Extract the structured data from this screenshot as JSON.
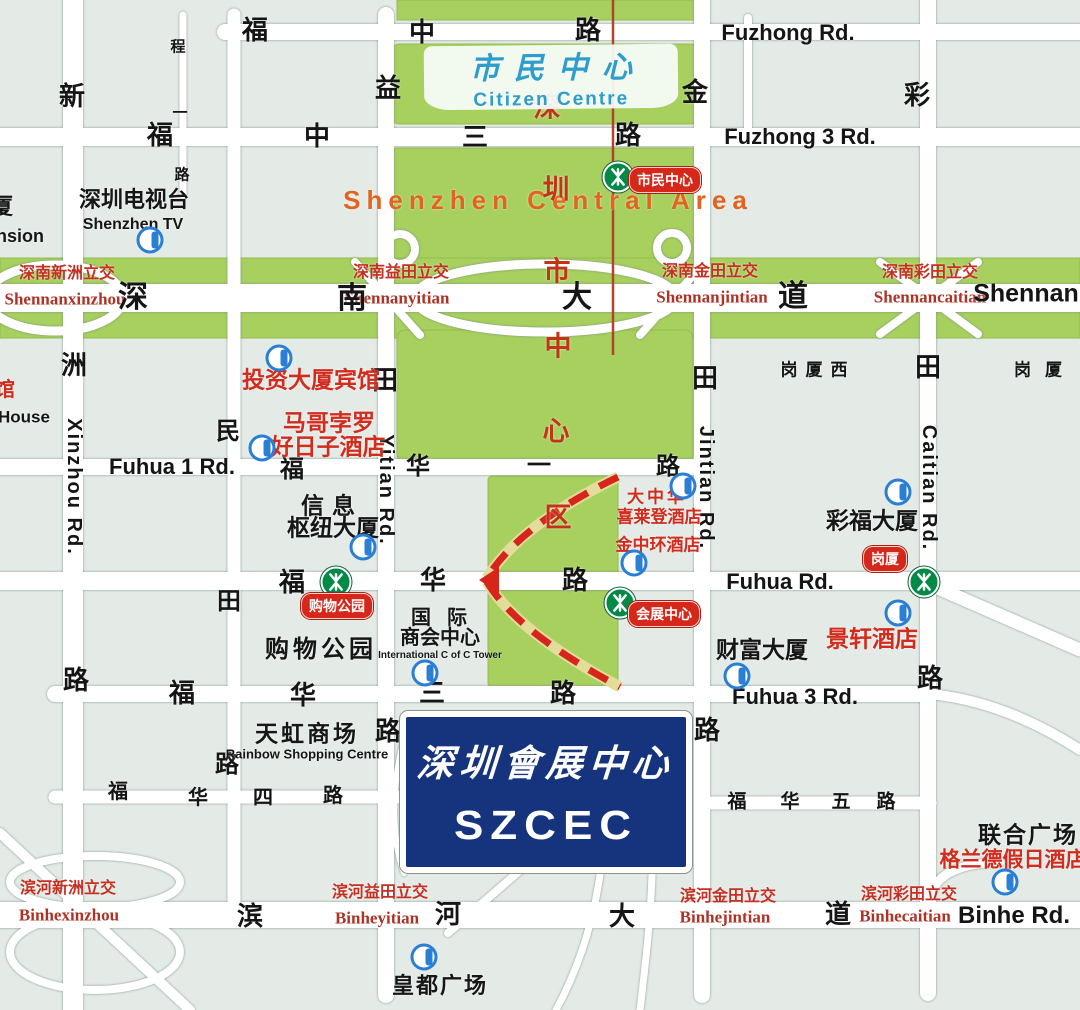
{
  "map": {
    "title": "SZCEC location map, Shenzhen Central Area",
    "colors": {
      "green_area": "#a7d05e",
      "block": "#e4ebe7",
      "road": "#ffffff",
      "szcec_blue": "#16337d",
      "red_label": "#d12c1d",
      "interchange_red": "#c53023",
      "orange_label": "#e2641e",
      "blue_label": "#2e9ccc",
      "metro_green": "#008a45",
      "badge_red": "#d6281a",
      "info_blue": "#2a7fd4",
      "axis_line_red": "#b5432a"
    },
    "citizen_centre": {
      "zh": "市民中心",
      "en": "Citizen Centre"
    },
    "szcec": {
      "zh": "深圳會展中心",
      "en": "SZCEC"
    },
    "central_area_en": "Shenzhen Central Area",
    "axis_text_vertical": "深圳市中心区",
    "labels": [
      {
        "n": "central-area-en",
        "t": "Shenzhen Central Area",
        "x": 548,
        "y": 200,
        "c": "orange",
        "fs": 26,
        "ls": 6
      },
      {
        "n": "axis-char",
        "t": "深",
        "x": 547,
        "y": 108,
        "c": "axis"
      },
      {
        "n": "axis-char",
        "t": "圳",
        "x": 556,
        "y": 190,
        "c": "axis"
      },
      {
        "n": "axis-char",
        "t": "市",
        "x": 557,
        "y": 272,
        "c": "axis"
      },
      {
        "n": "axis-char",
        "t": "中",
        "x": 558,
        "y": 347,
        "c": "axis"
      },
      {
        "n": "axis-char",
        "t": "心",
        "x": 556,
        "y": 432,
        "c": "axis"
      },
      {
        "n": "axis-char",
        "t": "区",
        "x": 558,
        "y": 518,
        "c": "axis"
      },
      {
        "n": "interchange-zh",
        "t": "深南新洲立交",
        "x": 67,
        "y": 274,
        "c": "izh"
      },
      {
        "n": "interchange-en",
        "t": "Shennanxinzhou",
        "x": 65,
        "y": 299,
        "c": "ien"
      },
      {
        "n": "interchange-zh",
        "t": "深南益田立交",
        "x": 401,
        "y": 273,
        "c": "izh"
      },
      {
        "n": "interchange-en",
        "t": "Shennanyitian",
        "x": 397,
        "y": 298,
        "c": "ien"
      },
      {
        "n": "interchange-zh",
        "t": "深南金田立交",
        "x": 710,
        "y": 272,
        "c": "izh"
      },
      {
        "n": "interchange-en",
        "t": "Shennanjintian",
        "x": 712,
        "y": 297,
        "c": "ien"
      },
      {
        "n": "interchange-zh",
        "t": "深南彩田立交",
        "x": 930,
        "y": 273,
        "c": "izh"
      },
      {
        "n": "interchange-en",
        "t": "Shennancaitian",
        "x": 930,
        "y": 297,
        "c": "ien"
      },
      {
        "n": "interchange-zh",
        "t": "滨河新洲立交",
        "x": 68,
        "y": 889,
        "c": "izh"
      },
      {
        "n": "interchange-en",
        "t": "Binhexinzhou",
        "x": 69,
        "y": 915,
        "c": "ien"
      },
      {
        "n": "interchange-zh",
        "t": "滨河益田立交",
        "x": 380,
        "y": 893,
        "c": "izh"
      },
      {
        "n": "interchange-en",
        "t": "Binheyitian",
        "x": 377,
        "y": 918,
        "c": "ien"
      },
      {
        "n": "interchange-zh",
        "t": "滨河金田立交",
        "x": 728,
        "y": 897,
        "c": "izh"
      },
      {
        "n": "interchange-en",
        "t": "Binhejintian",
        "x": 725,
        "y": 917,
        "c": "ien"
      },
      {
        "n": "interchange-zh",
        "t": "滨河彩田立交",
        "x": 909,
        "y": 895,
        "c": "izh"
      },
      {
        "n": "interchange-en",
        "t": "Binhecaitian",
        "x": 905,
        "y": 916,
        "c": "ien"
      },
      {
        "n": "road-char-fuzhong",
        "t": "福",
        "x": 255,
        "y": 30,
        "c": "rc"
      },
      {
        "n": "road-char-fuzhong",
        "t": "中",
        "x": 422,
        "y": 32,
        "c": "rc"
      },
      {
        "n": "road-char-fuzhong",
        "t": "路",
        "x": 588,
        "y": 30,
        "c": "rc"
      },
      {
        "n": "road-name-fuzhong-en",
        "t": "Fuzhong Rd.",
        "x": 788,
        "y": 33,
        "c": "re",
        "fs": 22
      },
      {
        "n": "road-char-fuzhong3",
        "t": "福",
        "x": 160,
        "y": 135,
        "c": "rc"
      },
      {
        "n": "road-char-fuzhong3",
        "t": "中",
        "x": 317,
        "y": 136,
        "c": "rc"
      },
      {
        "n": "road-char-fuzhong3",
        "t": "三",
        "x": 475,
        "y": 137,
        "c": "rc"
      },
      {
        "n": "road-char-fuzhong3",
        "t": "路",
        "x": 628,
        "y": 135,
        "c": "rc"
      },
      {
        "n": "road-name-fuzhong3-en",
        "t": "Fuzhong 3 Rd.",
        "x": 800,
        "y": 137,
        "c": "re",
        "fs": 22
      },
      {
        "n": "road-char-shennan",
        "t": "深",
        "x": 133,
        "y": 298,
        "c": "rc",
        "fs": 30
      },
      {
        "n": "road-char-shennan",
        "t": "南",
        "x": 352,
        "y": 299,
        "c": "rc",
        "fs": 30
      },
      {
        "n": "road-char-shennan",
        "t": "大",
        "x": 577,
        "y": 298,
        "c": "rc",
        "fs": 30
      },
      {
        "n": "road-char-shennan",
        "t": "道",
        "x": 793,
        "y": 297,
        "c": "rc",
        "fs": 30
      },
      {
        "n": "road-name-shennan-en",
        "t": "Shennan",
        "x": 1026,
        "y": 294,
        "c": "re",
        "fs": 25
      },
      {
        "n": "road-name-fuhua1-en",
        "t": "Fuhua 1 Rd.",
        "x": 172,
        "y": 467,
        "c": "re",
        "fs": 22
      },
      {
        "n": "road-char-fuhua1",
        "t": "福",
        "x": 292,
        "y": 470,
        "c": "rc",
        "fs": 24
      },
      {
        "n": "road-char-fuhua1",
        "t": "华",
        "x": 418,
        "y": 467,
        "c": "rc",
        "fs": 24
      },
      {
        "n": "road-char-fuhua1",
        "t": "一",
        "x": 539,
        "y": 466,
        "c": "rc",
        "fs": 24
      },
      {
        "n": "road-char-fuhua1",
        "t": "路",
        "x": 668,
        "y": 467,
        "c": "rc",
        "fs": 24
      },
      {
        "n": "road-char-fuhua",
        "t": "福",
        "x": 292,
        "y": 582,
        "c": "rc"
      },
      {
        "n": "road-char-fuhua",
        "t": "华",
        "x": 433,
        "y": 580,
        "c": "rc"
      },
      {
        "n": "road-char-fuhua",
        "t": "路",
        "x": 575,
        "y": 580,
        "c": "rc"
      },
      {
        "n": "road-name-fuhua-en",
        "t": "Fuhua Rd.",
        "x": 780,
        "y": 582,
        "c": "re",
        "fs": 22
      },
      {
        "n": "road-char-fuhua3",
        "t": "福",
        "x": 182,
        "y": 693,
        "c": "rc"
      },
      {
        "n": "road-char-fuhua3",
        "t": "华",
        "x": 303,
        "y": 695,
        "c": "rc"
      },
      {
        "n": "road-char-fuhua3",
        "t": "三",
        "x": 432,
        "y": 693,
        "c": "rc"
      },
      {
        "n": "road-char-fuhua3",
        "t": "路",
        "x": 563,
        "y": 693,
        "c": "rc"
      },
      {
        "n": "road-name-fuhua3-en",
        "t": "Fuhua 3 Rd.",
        "x": 795,
        "y": 697,
        "c": "re",
        "fs": 22
      },
      {
        "n": "road-char-fuhua4",
        "t": "福",
        "x": 118,
        "y": 792,
        "c": "rc",
        "fs": 20
      },
      {
        "n": "road-char-fuhua4",
        "t": "华",
        "x": 198,
        "y": 798,
        "c": "rc",
        "fs": 20
      },
      {
        "n": "road-char-fuhua4",
        "t": "四",
        "x": 263,
        "y": 798,
        "c": "rc",
        "fs": 20
      },
      {
        "n": "road-char-fuhua4",
        "t": "路",
        "x": 333,
        "y": 796,
        "c": "rc",
        "fs": 20
      },
      {
        "n": "road-char-fuhua5",
        "t": "福",
        "x": 737,
        "y": 802,
        "c": "rc",
        "fs": 19
      },
      {
        "n": "road-char-fuhua5",
        "t": "华",
        "x": 790,
        "y": 802,
        "c": "rc",
        "fs": 19
      },
      {
        "n": "road-char-fuhua5",
        "t": "五",
        "x": 841,
        "y": 802,
        "c": "rc",
        "fs": 19
      },
      {
        "n": "road-char-fuhua5",
        "t": "路",
        "x": 886,
        "y": 802,
        "c": "rc",
        "fs": 19
      },
      {
        "n": "road-char-binhe",
        "t": "滨",
        "x": 250,
        "y": 916,
        "c": "rc"
      },
      {
        "n": "road-char-binhe",
        "t": "河",
        "x": 448,
        "y": 914,
        "c": "rc"
      },
      {
        "n": "road-char-binhe",
        "t": "大",
        "x": 622,
        "y": 916,
        "c": "rc"
      },
      {
        "n": "road-char-binhe",
        "t": "道",
        "x": 838,
        "y": 914,
        "c": "rc"
      },
      {
        "n": "road-name-binhe-en",
        "t": "Binhe Rd.",
        "x": 1014,
        "y": 916,
        "c": "re",
        "fs": 24
      },
      {
        "n": "road-char-xinzhou",
        "t": "新",
        "x": 72,
        "y": 96,
        "c": "rc"
      },
      {
        "n": "road-char-xinzhou",
        "t": "洲",
        "x": 74,
        "y": 365,
        "c": "rc"
      },
      {
        "n": "road-name-xinzhou-en",
        "t": "Xinzhou Rd.",
        "x": 74,
        "y": 487,
        "c": "re vert",
        "fs": 20
      },
      {
        "n": "road-char-xinzhou",
        "t": "路",
        "x": 76,
        "y": 680,
        "c": "rc"
      },
      {
        "n": "road-char-chengyi",
        "t": "程",
        "x": 178,
        "y": 47,
        "c": "rc",
        "fs": 15
      },
      {
        "n": "road-char-chengyi",
        "t": "一",
        "x": 180,
        "y": 113,
        "c": "rc",
        "fs": 15
      },
      {
        "n": "road-char-chengyi",
        "t": "路",
        "x": 182,
        "y": 175,
        "c": "rc",
        "fs": 15
      },
      {
        "n": "road-char-mintian",
        "t": "民",
        "x": 228,
        "y": 432,
        "c": "rc",
        "fs": 24
      },
      {
        "n": "road-char-mintian",
        "t": "田",
        "x": 229,
        "y": 602,
        "c": "rc",
        "fs": 24
      },
      {
        "n": "road-char-mintian",
        "t": "路",
        "x": 227,
        "y": 765,
        "c": "rc",
        "fs": 24
      },
      {
        "n": "road-char-yitian",
        "t": "益",
        "x": 388,
        "y": 88,
        "c": "rc"
      },
      {
        "n": "road-char-yitian",
        "t": "田",
        "x": 385,
        "y": 380,
        "c": "rc"
      },
      {
        "n": "road-name-yitian-en",
        "t": "Yitian Rd.",
        "x": 386,
        "y": 490,
        "c": "re vert",
        "fs": 20
      },
      {
        "n": "road-char-yitian",
        "t": "路",
        "x": 388,
        "y": 731,
        "c": "rc"
      },
      {
        "n": "road-char-jintian",
        "t": "金",
        "x": 695,
        "y": 92,
        "c": "rc"
      },
      {
        "n": "road-char-jintian",
        "t": "田",
        "x": 705,
        "y": 378,
        "c": "rc"
      },
      {
        "n": "road-name-jintian-en",
        "t": "Jintian Rd.",
        "x": 706,
        "y": 488,
        "c": "re vert",
        "fs": 20
      },
      {
        "n": "road-char-jintian",
        "t": "路",
        "x": 707,
        "y": 730,
        "c": "rc"
      },
      {
        "n": "road-char-caitian",
        "t": "彩",
        "x": 917,
        "y": 95,
        "c": "rc"
      },
      {
        "n": "road-char-caitian",
        "t": "田",
        "x": 928,
        "y": 367,
        "c": "rc"
      },
      {
        "n": "road-name-caitian-en",
        "t": "Caitian Rd.",
        "x": 929,
        "y": 488,
        "c": "re vert",
        "fs": 20
      },
      {
        "n": "road-char-caitian",
        "t": "路",
        "x": 930,
        "y": 678,
        "c": "rc"
      },
      {
        "n": "building-shenzhen-tv",
        "t": "深圳电视台",
        "x": 134,
        "y": 200,
        "c": "bld",
        "fs": 22
      },
      {
        "n": "building-shenzhen-tv-en",
        "t": "Shenzhen TV",
        "x": 133,
        "y": 225,
        "c": "bld",
        "fs": 16
      },
      {
        "n": "building-partial",
        "t": "厦",
        "x": 2,
        "y": 207,
        "c": "bld",
        "fs": 22
      },
      {
        "n": "building-partial-en",
        "t": "nsion",
        "x": 20,
        "y": 236,
        "c": "bld",
        "fs": 18
      },
      {
        "n": "building-partial",
        "t": "馆",
        "x": 5,
        "y": 390,
        "c": "hotel",
        "fs": 20
      },
      {
        "n": "building-partial-en",
        "t": "House",
        "x": 24,
        "y": 417,
        "c": "bld",
        "fs": 17
      },
      {
        "n": "hotel-touzi",
        "t": "投资大厦宾馆",
        "x": 311,
        "y": 380,
        "c": "hotel",
        "fs": 23
      },
      {
        "n": "hotel-margo-polo",
        "t": "马哥孛罗",
        "x": 329,
        "y": 423,
        "c": "hotel",
        "fs": 23
      },
      {
        "n": "hotel-margo-polo",
        "t": "好日子酒店",
        "x": 328,
        "y": 447,
        "c": "hotel",
        "fs": 23
      },
      {
        "n": "building-xinxi",
        "t": "信息",
        "x": 332,
        "y": 506,
        "c": "bld",
        "fs": 23,
        "ls": 8
      },
      {
        "n": "building-xinxi",
        "t": "枢纽大厦",
        "x": 333,
        "y": 528,
        "c": "bld",
        "fs": 23
      },
      {
        "n": "hotel-sheraton",
        "t": "大中华",
        "x": 657,
        "y": 497,
        "c": "hotel",
        "fs": 17,
        "ls": 3
      },
      {
        "n": "hotel-sheraton",
        "t": "喜莱登酒店",
        "x": 659,
        "y": 517,
        "c": "hotel",
        "fs": 17
      },
      {
        "n": "hotel-jinzhonghuan",
        "t": "金中环酒店",
        "x": 658,
        "y": 545,
        "c": "hotel",
        "fs": 17
      },
      {
        "n": "building-caifu",
        "t": "彩福大厦",
        "x": 872,
        "y": 521,
        "c": "bld",
        "fs": 23
      },
      {
        "n": "area-gangxiaxi",
        "t": "岗厦西",
        "x": 818,
        "y": 370,
        "c": "bld",
        "fs": 17,
        "ls": 8
      },
      {
        "n": "area-gangxia",
        "t": "岗厦",
        "x": 1045,
        "y": 370,
        "c": "bld",
        "fs": 17,
        "ls": 14
      },
      {
        "n": "area-shopping-park",
        "t": "购物公园",
        "x": 321,
        "y": 650,
        "c": "bld",
        "fs": 24,
        "ls": 4
      },
      {
        "n": "building-icc",
        "t": "国际",
        "x": 447,
        "y": 618,
        "c": "bld",
        "fs": 20,
        "ls": 16
      },
      {
        "n": "building-icc",
        "t": "商会中心",
        "x": 440,
        "y": 638,
        "c": "bld",
        "fs": 20
      },
      {
        "n": "building-icc-en",
        "t": "International C of C Tower",
        "x": 440,
        "y": 656,
        "c": "bld",
        "fs": 10
      },
      {
        "n": "hotel-jingxuan",
        "t": "景轩酒店",
        "x": 872,
        "y": 639,
        "c": "hotel",
        "fs": 23
      },
      {
        "n": "building-fortune",
        "t": "财富大厦",
        "x": 762,
        "y": 650,
        "c": "bld",
        "fs": 23
      },
      {
        "n": "building-rainbow",
        "t": "天虹商场",
        "x": 307,
        "y": 734,
        "c": "bld",
        "fs": 23,
        "ls": 3
      },
      {
        "n": "building-rainbow-en",
        "t": "Rainbow Shopping Centre",
        "x": 307,
        "y": 754,
        "c": "bld",
        "fs": 13
      },
      {
        "n": "building-lianhe",
        "t": "联合广场",
        "x": 1028,
        "y": 835,
        "c": "bld",
        "fs": 23,
        "ls": 2
      },
      {
        "n": "hotel-grand",
        "t": "格兰德假日酒店",
        "x": 1013,
        "y": 860,
        "c": "hotel",
        "fs": 21
      },
      {
        "n": "building-huangdu",
        "t": "皇都广场",
        "x": 440,
        "y": 986,
        "c": "bld",
        "fs": 22,
        "ls": 2
      }
    ],
    "metro_badges": [
      {
        "n": "metro-badge-shiminzhongxin",
        "t": "市民中心",
        "x": 665,
        "y": 180
      },
      {
        "n": "metro-badge-gouwugongyuan",
        "t": "购物公园",
        "x": 337,
        "y": 606
      },
      {
        "n": "metro-badge-huizhanzhongxin",
        "t": "会展中心",
        "x": 664,
        "y": 614
      },
      {
        "n": "metro-badge-gangxia",
        "t": "岗厦",
        "x": 885,
        "y": 559
      }
    ],
    "metro_stations": [
      {
        "n": "metro-icon",
        "x": 618,
        "y": 177
      },
      {
        "n": "metro-icon",
        "x": 336,
        "y": 582
      },
      {
        "n": "metro-icon",
        "x": 620,
        "y": 603
      },
      {
        "n": "metro-icon",
        "x": 924,
        "y": 582
      }
    ],
    "info_markers": [
      {
        "n": "info-icon",
        "x": 150,
        "y": 240
      },
      {
        "n": "info-icon",
        "x": 279,
        "y": 358
      },
      {
        "n": "info-icon",
        "x": 262,
        "y": 448
      },
      {
        "n": "info-icon",
        "x": 363,
        "y": 547
      },
      {
        "n": "info-icon",
        "x": 425,
        "y": 673
      },
      {
        "n": "info-icon",
        "x": 683,
        "y": 486
      },
      {
        "n": "info-icon",
        "x": 634,
        "y": 563
      },
      {
        "n": "info-icon",
        "x": 898,
        "y": 492
      },
      {
        "n": "info-icon",
        "x": 737,
        "y": 676
      },
      {
        "n": "info-icon",
        "x": 898,
        "y": 613
      },
      {
        "n": "info-icon",
        "x": 1005,
        "y": 882
      },
      {
        "n": "info-icon",
        "x": 424,
        "y": 957
      }
    ]
  }
}
